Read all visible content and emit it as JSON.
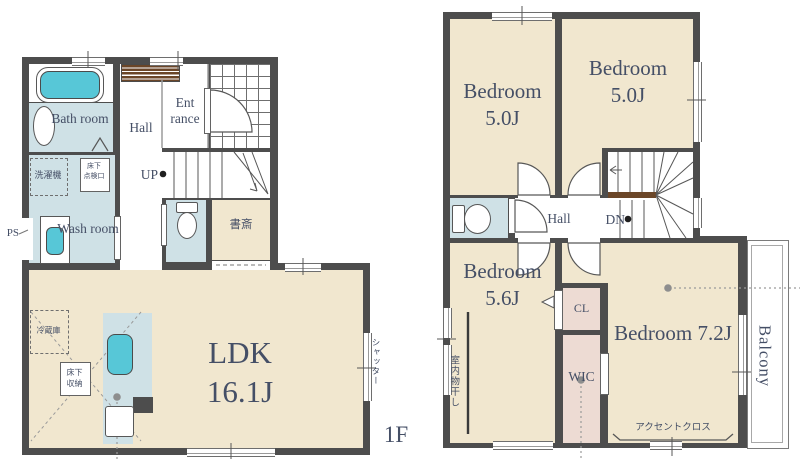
{
  "colors": {
    "wall": "#4d4d4d",
    "room": "#f1e7cf",
    "wet": "#cfe1e6",
    "fixture": "#57c7d7",
    "closet": "#eddbd3",
    "cabinet": "#6b4628",
    "ink": "#454f66"
  },
  "floor1": {
    "floor_label": "1F",
    "bath_room": "Bath room",
    "hall": "Hall",
    "entrance": "Ent rance",
    "up": "UP",
    "wash_room": "Wash room",
    "study": "書斎",
    "ldk": "LDK 16.1J",
    "laundry_machine": "洗濯機",
    "underfloor_access": "床下\n点検口",
    "underfloor_storage": "床下\n収納",
    "refrigerator": "冷蔵庫",
    "pipe_space": "PS",
    "shutter": "シャッター"
  },
  "floor2": {
    "bedroom_left": "Bedroom 5.0J",
    "bedroom_right": "Bedroom 5.0J",
    "hall": "Hall",
    "down": "DN",
    "bedroom_southwest": "Bedroom 5.6J",
    "closet": "CL",
    "walk_in_closet": "WIC",
    "bedroom_main": "Bedroom 7.2J",
    "balcony": "Balcony",
    "indoor_drying": "室内物干し",
    "accent_cloth": "アクセントクロス"
  }
}
